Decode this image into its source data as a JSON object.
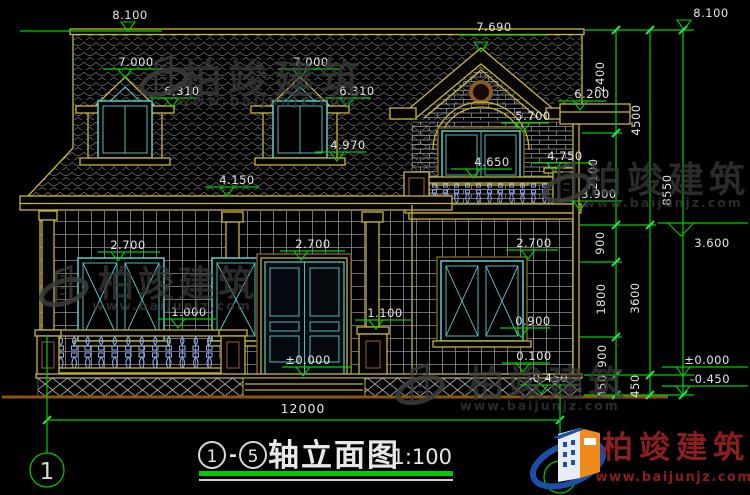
{
  "title": {
    "axis_start": "1",
    "axis_end": "5",
    "dash": "-",
    "name": "轴立面图",
    "scale": "1:100"
  },
  "axis_bubbles": {
    "left": "1"
  },
  "brand": {
    "name": "柏竣建筑",
    "url": "www.baijunjz.com"
  },
  "colors": {
    "dimension_green": "#00cf00",
    "line_yellow": "#c9b535",
    "frame_teal": "#58cfcf",
    "baluster_blue": "#8aa6e8",
    "logo_red": "#8b1e1e",
    "logo_blue": "#1d4fa8",
    "logo_orange": "#ef8a1c"
  },
  "elevations": {
    "ridge_left": "8.100",
    "ridge_right": "8.100",
    "dormer1_peak": "7.000",
    "dormer1_eave": "6.310",
    "dormer2_peak": "7.000",
    "dormer2_eave": "6.310",
    "dormer2_sill": "4.970",
    "gable_peak": "7.690",
    "upper_eave": "6.200",
    "main_eave": "4.150",
    "arch_top": "5.700",
    "wall_ledge": "4.750",
    "balcony_rail": "4.650",
    "balcony_floor": "3.900",
    "floor2": "3.600",
    "window_left_top": "2.700",
    "door_head": "2.700",
    "window_right_top": "2.700",
    "porch_rail": "1.000",
    "pier_top": "1.100",
    "window_sill": "0.900",
    "porch_floor": "0.100",
    "zero_door": "±0.000",
    "ground_left": "-0.450",
    "zero_right": "±0.000",
    "ground_right": "-0.450"
  },
  "dimensions": {
    "chain_inner": [
      "2400",
      "2100",
      "900",
      "1800",
      "900",
      "450"
    ],
    "chain_mid": [
      "4500",
      "3600",
      "450"
    ],
    "total_height": "8550",
    "total_width": "12000"
  }
}
